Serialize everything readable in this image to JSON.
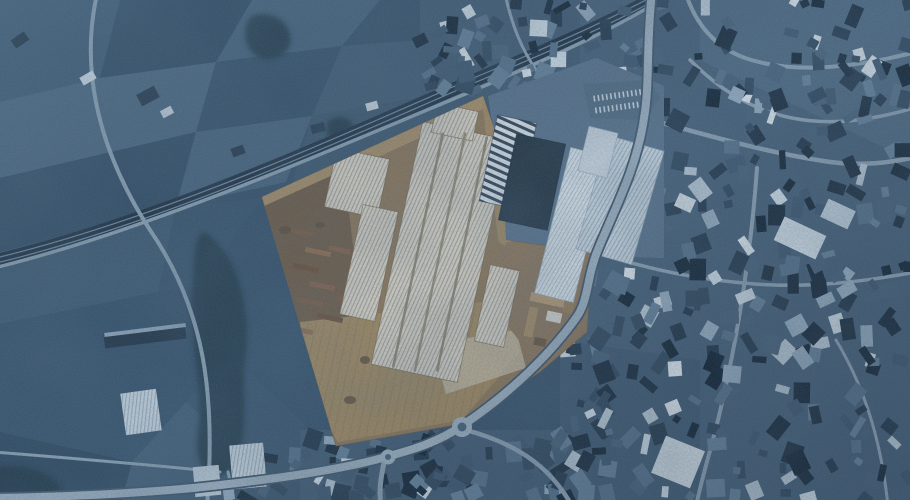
{
  "scene": {
    "kind": "aerial-satellite-photo-with-highlighted-parcel",
    "canvas": {
      "width": 910,
      "height": 500
    },
    "palette": {
      "base": "#33506b",
      "road": "#8ba2b5",
      "road_major": "#9cb1c2",
      "road_casing": "#3c536a",
      "rail_band": "#1b2e41",
      "rail_line": "#6d8aa2",
      "vegetation": "#203649",
      "parcel_base": "#8b7457",
      "parcel_dirt": "#ab9168",
      "urban_bright": [
        "#b9cad8",
        "#cfdde8",
        "#93abc0",
        "#dfe9f1"
      ],
      "urban_mid": [
        "#44607a",
        "#53708b",
        "#62809a",
        "#3a5570"
      ],
      "urban_dark": [
        "#16293c",
        "#1f354a",
        "#2c455c",
        "#0f2234"
      ]
    },
    "patterns": [
      {
        "id": "ridgeWarm",
        "bg": "#d8d4c9",
        "line": "#a9a296",
        "spacing": 3.6,
        "lw": 1.1,
        "angle": 12
      },
      {
        "id": "ridgeBlue",
        "bg": "#ccd9e3",
        "line": "#9db1c2",
        "spacing": 3.6,
        "lw": 1.1,
        "angle": 14
      },
      {
        "id": "ridgeBlue2",
        "bg": "#dde6ed",
        "line": "#b3c4d2",
        "spacing": 3.4,
        "lw": 1.0,
        "angle": 16
      },
      {
        "id": "zebra",
        "bg": "#dce4ec",
        "line": "#2f4254",
        "spacing": 7,
        "lw": 3,
        "angle": 102
      },
      {
        "id": "yardStripe",
        "bg": "none",
        "line": "#8e7854",
        "spacing": 8,
        "lw": 1.2,
        "angle": 12
      }
    ],
    "fields": [
      {
        "pts": "0,0 120,0 100,78 0,102",
        "fill": "#3a5873"
      },
      {
        "pts": "120,0 252,0 216,62 100,78",
        "fill": "#2c4962"
      },
      {
        "pts": "252,0 380,0 342,46 216,62",
        "fill": "#41607b"
      },
      {
        "pts": "380,0 520,0 472,36 342,46",
        "fill": "#324f69"
      },
      {
        "pts": "0,102 100,78 216,62 196,132 0,178",
        "fill": "#47657f"
      },
      {
        "pts": "216,62 342,46 312,116 196,132",
        "fill": "#324f69"
      },
      {
        "pts": "342,46 472,36 432,96 312,116",
        "fill": "#3d5a74"
      },
      {
        "pts": "0,178 196,132 176,206 0,252",
        "fill": "#2f4c66"
      },
      {
        "pts": "196,132 312,116 286,182 176,206",
        "fill": "#44627d"
      },
      {
        "pts": "312,116 450,92 480,100 290,190",
        "fill": "#39566f"
      },
      {
        "pts": "450,92 520,70 560,100 497,128 480,100",
        "fill": "#3c5870"
      },
      {
        "pts": "0,252 176,206 158,292 0,324",
        "fill": "#3b5973"
      },
      {
        "pts": "176,206 262,198 200,286 158,292",
        "fill": "#35536d"
      },
      {
        "pts": "0,324 158,292 186,402 132,462 0,432",
        "fill": "#33516c"
      },
      {
        "pts": "0,432 132,462 122,500 0,500",
        "fill": "#2b4760"
      },
      {
        "pts": "132,462 186,402 232,442 226,500 122,500",
        "fill": "#3e5c77"
      },
      {
        "pts": "186,402 228,352 300,420 330,452 318,500 226,500 232,442",
        "fill": "#36536e"
      }
    ],
    "city_grounds": [
      {
        "pts": "560,0 910,0 910,500 560,500",
        "fill": "#425e78"
      },
      {
        "pts": "700,0 910,0 910,160 700,60",
        "fill": "#4a6781"
      },
      {
        "pts": "560,340 700,360 700,500 560,500",
        "fill": "#3c5872"
      },
      {
        "pts": "300,430 560,430 560,500 300,500",
        "fill": "#3e5a74"
      },
      {
        "pts": "420,0 580,0 580,95 420,95",
        "fill": "#3d5973"
      }
    ],
    "vegetation": [
      "M204,232 C232,248 252,300 246,352 C240,402 252,438 232,468 C212,488 192,468 198,430 C204,392 188,332 192,292 C195,262 192,240 204,232 Z",
      "M252,16 C268,10 286,18 290,34 C294,50 280,62 262,58 C244,54 240,26 252,16 Z",
      "M-10,468 C20,462 48,470 60,486 C66,496 50,504 20,504 L-10,504 Z",
      "M330,120 C340,114 352,118 354,128 C356,138 346,144 336,141 C326,138 324,126 330,120 Z"
    ],
    "railway": {
      "d": "M-10,262 C150,224 310,152 470,82 C562,44 624,16 676,-14",
      "band_w": 13,
      "line_w": 1.2,
      "line_offset": 2.6
    },
    "minor_roads": [
      {
        "d": "M97,-6 C82,60 92,140 150,230 C205,310 216,395 207,506",
        "w": 4
      },
      {
        "d": "M-6,268 C140,232 300,163 470,92 C560,54 622,25 674,-8",
        "w": 3.5
      },
      {
        "d": "M-6,452 C70,458 142,464 220,472",
        "w": 3
      },
      {
        "d": "M644,118 C700,133 762,152 830,162 C862,166 888,163 916,157",
        "w": 4.5
      },
      {
        "d": "M916,52 C852,68 795,74 748,59 C714,48 695,22 686,-6",
        "w": 4
      },
      {
        "d": "M597,252 C648,270 700,280 755,284 C810,288 862,282 916,272",
        "w": 3.5
      },
      {
        "d": "M757,168 C752,240 740,330 718,420 C710,452 702,478 696,506",
        "w": 4
      },
      {
        "d": "M690,60 C720,90 752,110 792,118 C832,126 872,120 914,108",
        "w": 3.5
      },
      {
        "d": "M505,-6 C512,25 521,48 536,70",
        "w": 3
      },
      {
        "d": "M836,340 C860,380 880,430 888,506",
        "w": 3
      },
      {
        "d": "M228,472 C232,488 232,497 231,506",
        "w": 3
      }
    ],
    "urban_patches": [
      {
        "x": 585,
        "y": 0,
        "w": 325,
        "h": 500,
        "count": 300,
        "seed": 11
      },
      {
        "x": 420,
        "y": 0,
        "w": 165,
        "h": 92,
        "count": 42,
        "seed": 22
      },
      {
        "x": 300,
        "y": 438,
        "w": 265,
        "h": 62,
        "count": 64,
        "seed": 33
      },
      {
        "x": 228,
        "y": 455,
        "w": 80,
        "h": 45,
        "count": 15,
        "seed": 44
      },
      {
        "x": 558,
        "y": 345,
        "w": 50,
        "h": 155,
        "count": 22,
        "seed": 55
      }
    ],
    "landmark_buildings": [
      [
        20,
        40,
        16,
        10,
        -35,
        "#1c3143"
      ],
      [
        88,
        78,
        15,
        9,
        -30,
        "#cfdce7"
      ],
      [
        148,
        96,
        20,
        13,
        -28,
        "#22374b"
      ],
      [
        167,
        112,
        12,
        8,
        -28,
        "#c2d2df"
      ],
      [
        238,
        151,
        13,
        9,
        -20,
        "#20354a"
      ],
      [
        318,
        128,
        14,
        9,
        -15,
        "#24394e"
      ],
      [
        372,
        106,
        12,
        8,
        -15,
        "#cdd9e4"
      ],
      [
        431,
        86,
        12,
        8,
        -15,
        "#2a3f54"
      ],
      [
        145,
        336,
        82,
        15,
        -7,
        "#1e3346"
      ],
      [
        145,
        330,
        82,
        4,
        -7,
        "#8fa6bb"
      ],
      [
        141,
        412,
        36,
        42,
        -8,
        "ridgeBlue"
      ],
      [
        248,
        466,
        34,
        44,
        -5,
        "ridgeBlue"
      ],
      [
        207,
        481,
        26,
        30,
        -5,
        "#b7c8d6"
      ],
      [
        678,
        462,
        42,
        40,
        22,
        "#d6e2eb"
      ],
      [
        800,
        238,
        46,
        26,
        25,
        "#cfdde8"
      ],
      [
        838,
        214,
        30,
        20,
        25,
        "#c2d3e0"
      ]
    ],
    "industrial_zone": {
      "ground": {
        "pts": "488,96 596,58 664,86 664,258 592,256 504,240 496,150",
        "fill": "#56718c"
      },
      "factories": [
        [
          508,
          162,
          40,
          88,
          12,
          "zebra",
          "#223648"
        ],
        [
          532,
          182,
          50,
          88,
          12,
          "#1d3040",
          "#101f2e"
        ],
        [
          572,
          225,
          40,
          150,
          14,
          "ridgeBlue2",
          "#8ea3b5"
        ],
        [
          620,
          200,
          58,
          118,
          16,
          "ridgeBlue",
          "#8ea3b5"
        ],
        [
          598,
          152,
          30,
          46,
          14,
          "#cdd9e3",
          "#8ea3b5"
        ]
      ]
    },
    "parking_lot": {
      "pts": "583,84 650,80 660,98 644,120 590,118",
      "fill": "#4e6a83",
      "dash_fill": "#cfdae3",
      "rows": [
        92,
        104
      ],
      "x0": 594,
      "cols": 12,
      "dx": 4.2,
      "dw": 1.6,
      "dh": 6,
      "rot": -8
    },
    "major_road": {
      "d": "M652,-8 C646,44 650,84 644,118 C637,168 614,210 597,252 C586,280 589,300 576,318 C552,352 512,392 463,425 C436,444 407,451 386,457 C332,472 258,481 193,488 C128,494 58,497 -8,498",
      "casing_w": 11.5,
      "w": 8,
      "branches": [
        {
          "d": "M466,430 C510,442 548,462 572,506",
          "w": 4.5
        },
        {
          "d": "M385,458 C380,480 379,492 381,506",
          "w": 5
        }
      ]
    },
    "roundabouts": [
      {
        "cx": 462,
        "cy": 427,
        "r": 10,
        "ri": 4.5
      },
      {
        "cx": 388,
        "cy": 457,
        "r": 7.5,
        "ri": 3
      }
    ],
    "parcel": {
      "polygon": "262,197 483,96 503,155 506,240 592,252 587,332 540,372 461,424 336,446",
      "base": "#8b7457",
      "edge": "#6b5840",
      "dirt_strokes": [
        {
          "d": "M262,199 L483,98",
          "w": 20,
          "c": "#ab9168"
        },
        {
          "d": "M489,100 L505,238",
          "w": 14,
          "c": "#a38a62"
        },
        {
          "d": "M300,210 C320,260 330,330 340,420",
          "w": 5,
          "c": "#a38a62"
        }
      ],
      "ground_polys": [
        {
          "pts": "264,206 344,170 364,338 332,418 282,282",
          "fill": "#6d5a45"
        },
        {
          "pts": "300,322 500,300 520,352 462,420 338,442 306,392",
          "fill": "#a0885f"
        },
        {
          "pts": "300,322 500,300 520,352 462,420 338,442 306,392",
          "fill": "yardStripe",
          "op": 0.55
        },
        {
          "pts": "432,344 516,330 526,368 446,394",
          "fill": "#c6bca7",
          "op": 0.75
        },
        {
          "pts": "506,242 590,254 586,330 540,368 505,322",
          "fill": "#8d755a"
        }
      ],
      "structures": [
        [
          300,
          232,
          26,
          5,
          12,
          "#7c5a41"
        ],
        [
          318,
          252,
          26,
          5,
          12,
          "#8f6b4d"
        ],
        [
          306,
          268,
          26,
          5,
          12,
          "#6b4f3a"
        ],
        [
          322,
          286,
          26,
          5,
          12,
          "#83604a"
        ],
        [
          310,
          302,
          26,
          5,
          12,
          "#7c5a41"
        ],
        [
          330,
          318,
          26,
          5,
          12,
          "#6b4f3a"
        ],
        [
          300,
          330,
          26,
          5,
          12,
          "#8f6b4d"
        ],
        [
          340,
          250,
          22,
          5,
          12,
          "#83604a"
        ],
        [
          348,
          300,
          22,
          5,
          12,
          "#7c5a41"
        ],
        [
          548,
          300,
          36,
          9,
          12,
          "#b59a74"
        ],
        [
          531,
          322,
          9,
          30,
          12,
          "#a78c64"
        ],
        [
          554,
          317,
          15,
          10,
          12,
          "#d9d8d2"
        ],
        [
          540,
          342,
          12,
          8,
          12,
          "#6b5540"
        ],
        [
          570,
          300,
          10,
          26,
          12,
          "#977d59"
        ],
        [
          357,
          183,
          54,
          60,
          12,
          "ridgeWarm",
          "#6b5a3e"
        ],
        [
          369,
          263,
          36,
          112,
          12,
          "ridgeWarm",
          "#6b5a3e"
        ],
        [
          440,
          252,
          88,
          248,
          12,
          "ridgeWarm",
          "#6b5a3e"
        ],
        [
          455,
          122,
          42,
          30,
          12,
          "ridgeWarm",
          "#6b5a3e"
        ],
        [
          497,
          306,
          30,
          78,
          12,
          "ridgeWarm",
          "#6b5a3e"
        ],
        [
          418,
          250,
          2.5,
          240,
          12,
          "#8d8572"
        ],
        [
          440,
          252,
          2.5,
          244,
          12,
          "#938b78"
        ],
        [
          462,
          254,
          2.5,
          240,
          12,
          "#8d8572"
        ]
      ],
      "specks": [
        [
          285,
          230,
          6,
          4
        ],
        [
          295,
          350,
          7,
          5
        ],
        [
          350,
          400,
          6,
          4
        ],
        [
          320,
          225,
          5,
          3
        ],
        [
          275,
          320,
          6,
          4
        ],
        [
          365,
          360,
          5,
          4
        ]
      ]
    }
  }
}
